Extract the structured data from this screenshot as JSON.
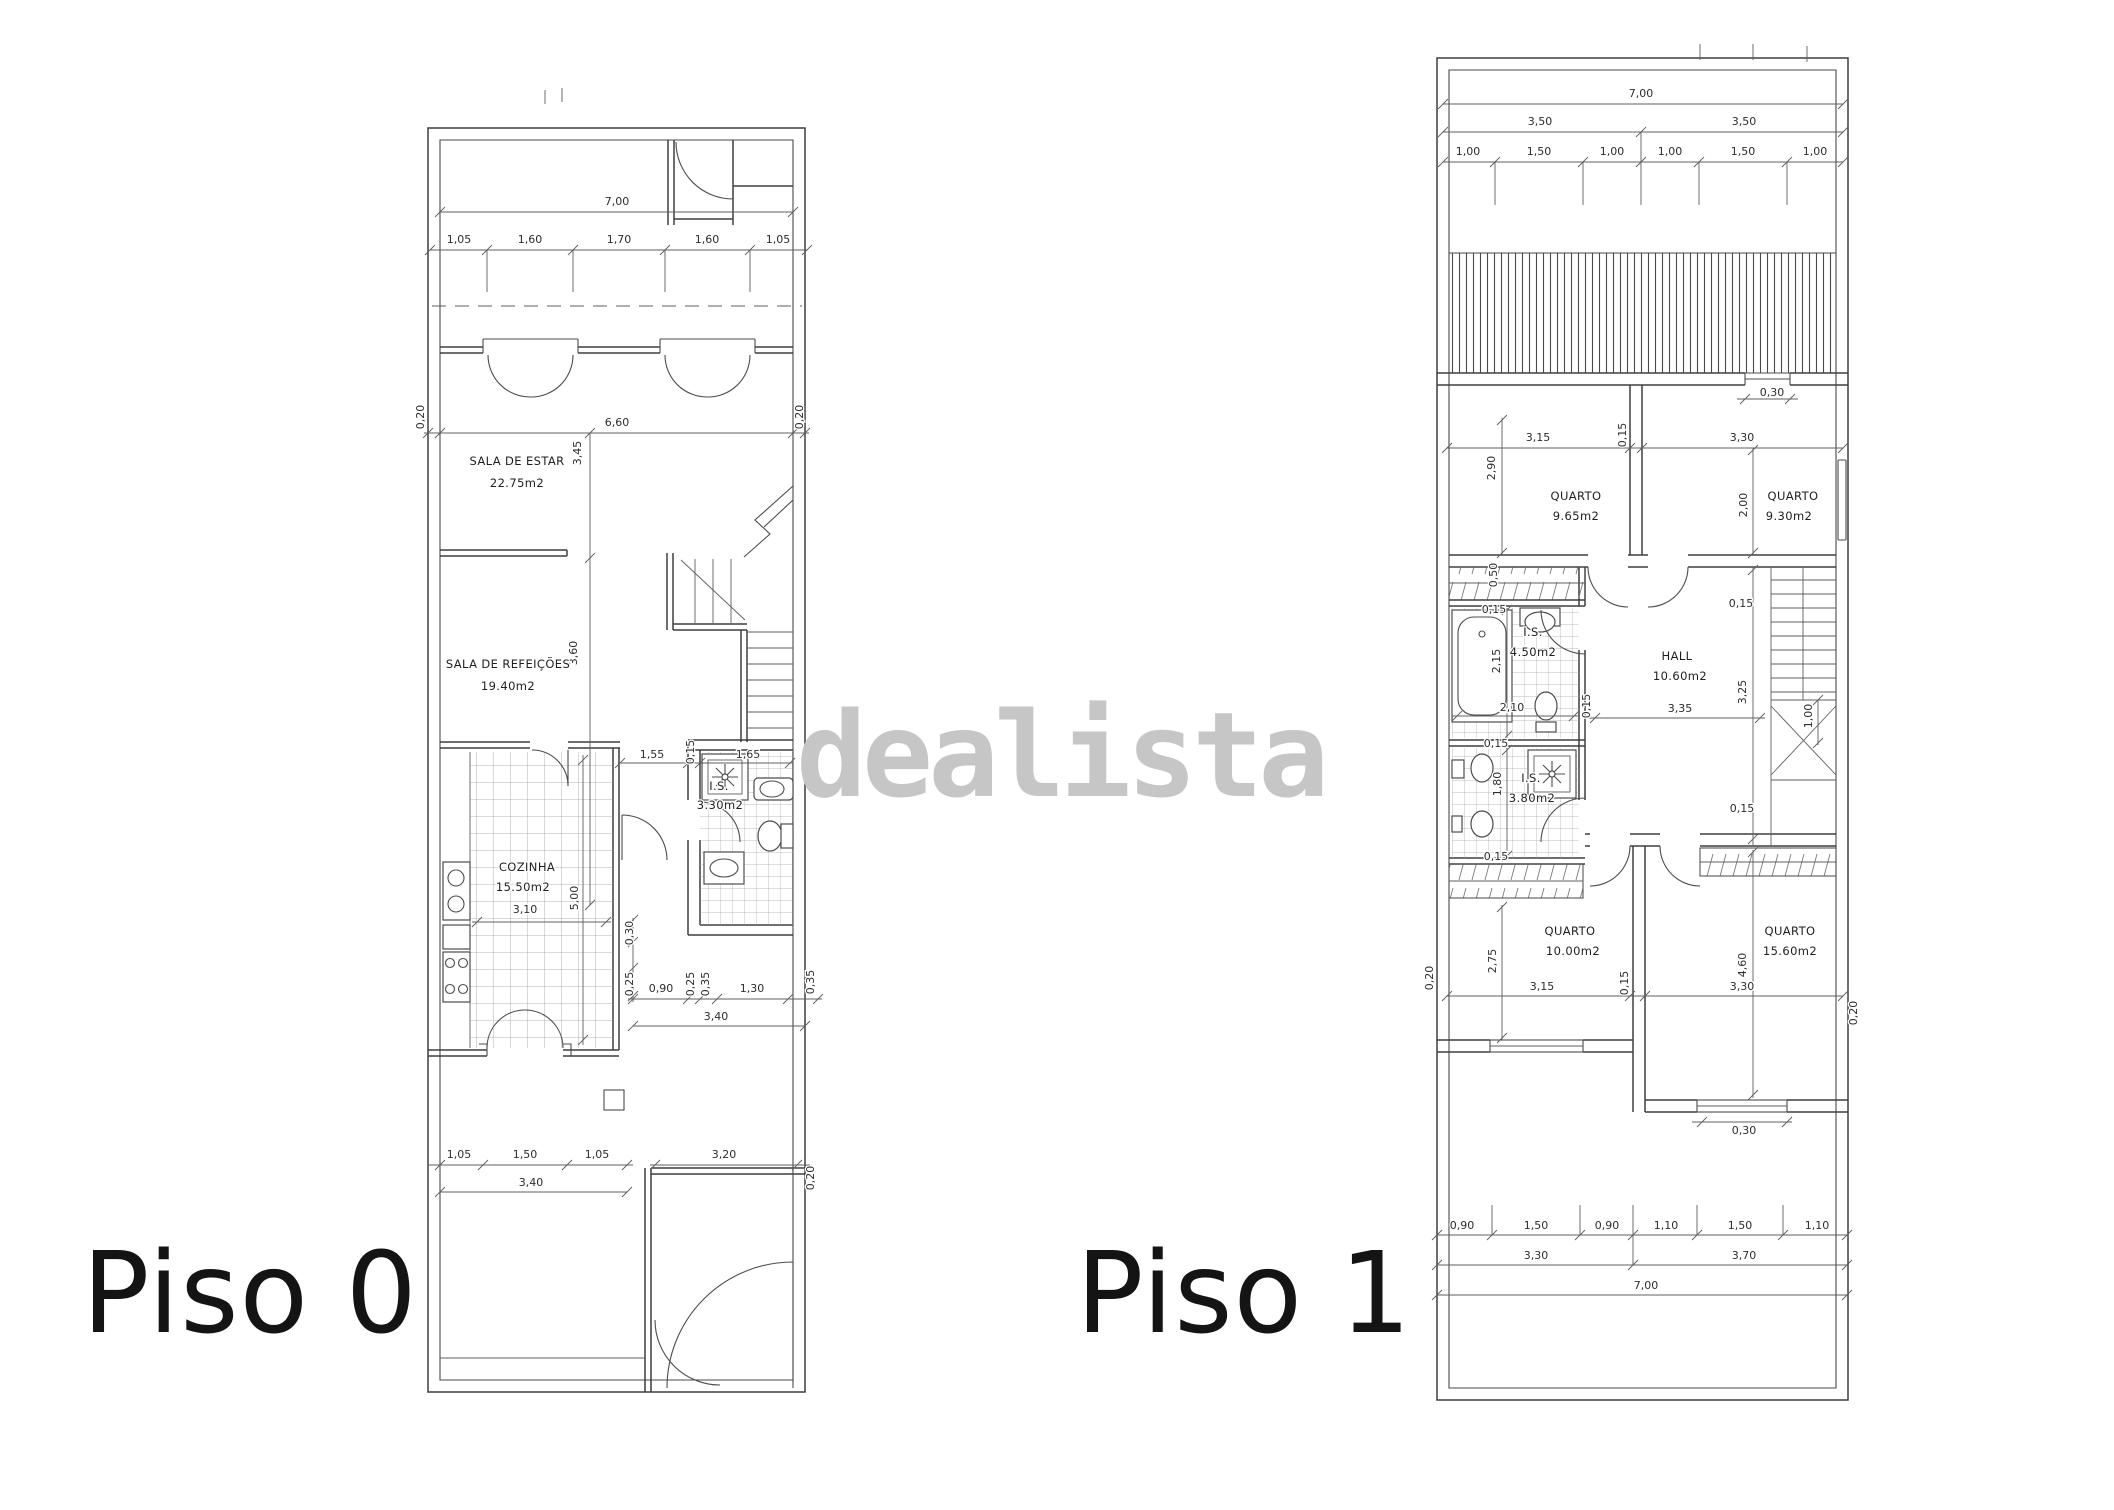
{
  "watermark": {
    "text": "dealista"
  },
  "piso0": {
    "title": "Piso 0",
    "rooms": {
      "sala_estar": {
        "name": "SALA DE ESTAR",
        "area": "22.75m2"
      },
      "sala_refeicoes": {
        "name": "SALA DE REFEIÇÕES",
        "area": "19.40m2"
      },
      "cozinha": {
        "name": "COZINHA",
        "area": "15.50m2"
      },
      "is": {
        "name": "I.S.",
        "area": "3.30m2"
      }
    },
    "dims": {
      "top_total": "7,00",
      "top_segs": [
        "1,05",
        "1,60",
        "1,70",
        "1,60",
        "1,05"
      ],
      "wall_left": "0,20",
      "wall_right": "0,20",
      "sala_width": "6,60",
      "sala_estar_h": "3,45",
      "sala_refeicoes_h": "3,60",
      "cozinha_w": "3,10",
      "cozinha_h": "5,00",
      "is_segs": [
        "1,55",
        "0,15",
        "1,65"
      ],
      "mid_segs": [
        "0,30",
        "0,25",
        "0,90",
        "0,25",
        "0,35",
        "1,30",
        "0,35"
      ],
      "mid_total": "3,40",
      "bottom_segs": [
        "1,05",
        "1,50",
        "1,05",
        "3,20"
      ],
      "bottom_total": "3,40",
      "bottom_right": "0,20"
    }
  },
  "piso1": {
    "title": "Piso 1",
    "rooms": {
      "quarto1": {
        "name": "QUARTO",
        "area": "9.65m2"
      },
      "quarto2": {
        "name": "QUARTO",
        "area": "9.30m2"
      },
      "is1": {
        "name": "I.S.",
        "area": "4.50m2"
      },
      "hall": {
        "name": "HALL",
        "area": "10.60m2"
      },
      "is2": {
        "name": "I.S.",
        "area": "3.80m2"
      },
      "quarto3": {
        "name": "QUARTO",
        "area": "10.00m2"
      },
      "quarto4": {
        "name": "QUARTO",
        "area": "15.60m2"
      }
    },
    "dims": {
      "top_total": "7,00",
      "top_halves": [
        "3,50",
        "3,50"
      ],
      "top_segs": [
        "1,00",
        "1,50",
        "1,00",
        "1,00",
        "1,50",
        "1,00"
      ],
      "terrace_window": "0,30",
      "quarto1_w": "3,15",
      "quarto1_h": "2,90",
      "quarto_wall": "0,15",
      "quarto2_w": "3,30",
      "quarto2_h": "2,00",
      "closet_d": "0,50",
      "is1_top": "0,15",
      "is1_h": "2,15",
      "is1_w": "2,10",
      "is1_wall": "0,15",
      "hall_top": "0,15",
      "hall_w": "3,35",
      "hall_h": "3,25",
      "stairs_w": "1,00",
      "is2_top": "0,15",
      "is2_h": "1,80",
      "is2_bottom": "0,15",
      "hall_bottom": "0,15",
      "quarto3_h": "2,75",
      "quarto3_w": "3,15",
      "quarto3_wall": "0,15",
      "quarto4_h": "4,60",
      "quarto4_w": "3,30",
      "left_wall": "0,20",
      "right_wall": "0,20",
      "quarto4_window": "0,30",
      "bottom_segs": [
        "0,90",
        "1,50",
        "0,90",
        "1,10",
        "1,50",
        "1,10"
      ],
      "bottom_halves": [
        "3,30",
        "3,70"
      ],
      "bottom_total": "7,00"
    }
  }
}
